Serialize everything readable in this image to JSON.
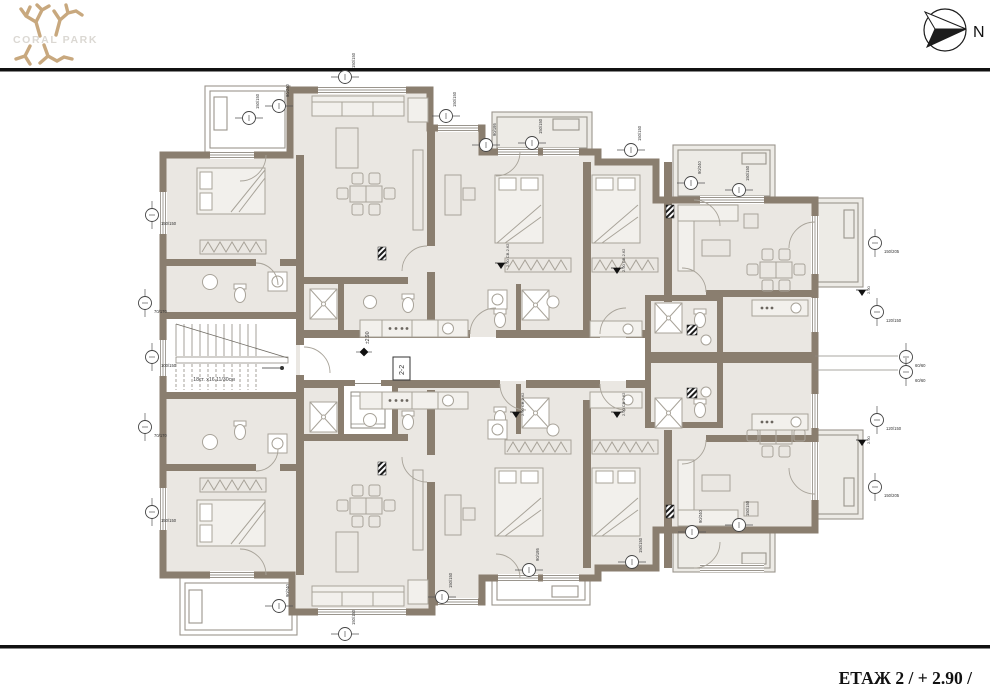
{
  "header": {
    "logo_text": "CORAL PARK",
    "compass_label": "N"
  },
  "footer": {
    "title": "ЕТАЖ 2 / + 2.90 /"
  },
  "plan": {
    "stair_note": "18ст. х16.11/30см",
    "section_marker": "2-2",
    "corridor_level": "±2.90",
    "colors": {
      "wall": "#8a7e6f",
      "floor": "#eae7e2",
      "balcony_floor": "#edebe6",
      "line": "#a8a399",
      "logo_tan": "#c8a87e",
      "logo_gray": "#dbd8d3",
      "black": "#111111"
    },
    "dim_markers": [
      {
        "x": 345,
        "y": 77,
        "label": "150/150",
        "vert": false
      },
      {
        "x": 249,
        "y": 118,
        "label": "150/150",
        "vert": false
      },
      {
        "x": 279,
        "y": 106,
        "label": "90/240",
        "vert": false
      },
      {
        "x": 446,
        "y": 116,
        "label": "150/150",
        "vert": false
      },
      {
        "x": 486,
        "y": 145,
        "label": "90/195",
        "vert": false
      },
      {
        "x": 532,
        "y": 143,
        "label": "150/150",
        "vert": false
      },
      {
        "x": 631,
        "y": 150,
        "label": "150/150",
        "vert": false
      },
      {
        "x": 691,
        "y": 183,
        "label": "90/240",
        "vert": false
      },
      {
        "x": 739,
        "y": 190,
        "label": "150/150",
        "vert": false
      },
      {
        "x": 152,
        "y": 215,
        "label": "150/150",
        "vert": true
      },
      {
        "x": 152,
        "y": 357,
        "label": "100/150",
        "vert": true
      },
      {
        "x": 152,
        "y": 512,
        "label": "150/150",
        "vert": true
      },
      {
        "x": 145,
        "y": 303,
        "label": "70/170",
        "vert": true
      },
      {
        "x": 145,
        "y": 427,
        "label": "70/170",
        "vert": true
      },
      {
        "x": 875,
        "y": 243,
        "label": "150/205",
        "vert": true
      },
      {
        "x": 877,
        "y": 312,
        "label": "120/150",
        "vert": true
      },
      {
        "x": 877,
        "y": 420,
        "label": "120/150",
        "vert": true
      },
      {
        "x": 875,
        "y": 487,
        "label": "150/205",
        "vert": true
      },
      {
        "x": 906,
        "y": 357,
        "label": "60/60",
        "vert": true
      },
      {
        "x": 906,
        "y": 372,
        "label": "60/60",
        "vert": true
      },
      {
        "x": 442,
        "y": 597,
        "label": "150/150",
        "vert": false
      },
      {
        "x": 529,
        "y": 570,
        "label": "90/195",
        "vert": false
      },
      {
        "x": 632,
        "y": 562,
        "label": "150/150",
        "vert": false
      },
      {
        "x": 692,
        "y": 532,
        "label": "90/240",
        "vert": false
      },
      {
        "x": 739,
        "y": 525,
        "label": "150/150",
        "vert": false
      },
      {
        "x": 345,
        "y": 634,
        "label": "150/150",
        "vert": false
      },
      {
        "x": 279,
        "y": 606,
        "label": "90/240",
        "vert": false
      }
    ],
    "level_markers": [
      {
        "x": 497,
        "y": 263,
        "label": "2.90 СВ.2.62"
      },
      {
        "x": 613,
        "y": 268,
        "label": "2.90 СВ.2.62"
      },
      {
        "x": 512,
        "y": 412,
        "label": "2.90 СВ.2.62"
      },
      {
        "x": 613,
        "y": 412,
        "label": "2.90 СВ.2.62"
      },
      {
        "x": 858,
        "y": 290,
        "label": "2.90"
      },
      {
        "x": 858,
        "y": 440,
        "label": "2.90"
      }
    ]
  }
}
